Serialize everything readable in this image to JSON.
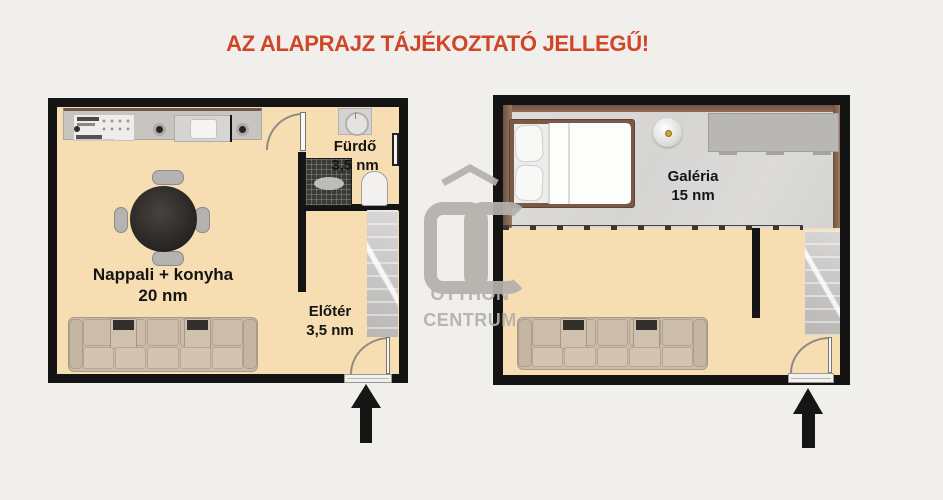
{
  "title": {
    "text": "AZ ALAPRAJZ TÁJÉKOZTATÓ JELLEGŰ!"
  },
  "plans": {
    "left": {
      "rooms": {
        "living": {
          "name": "Nappali + konyha",
          "area": "20 nm"
        },
        "bath": {
          "name": "Fürdő",
          "area": "3,5 nm"
        },
        "hall": {
          "name": "Előtér",
          "area": "3,5 nm"
        }
      }
    },
    "right": {
      "rooms": {
        "gallery": {
          "name": "Galéria",
          "area": "15 nm"
        }
      }
    }
  },
  "watermark": {
    "initials": "OC",
    "line1": "OTTHON",
    "line2": "CENTRUM"
  },
  "icons": {
    "entrance_arrow": "up-arrow",
    "door": "quarter-arc-door",
    "washing_machine": "washer-drum",
    "ceiling_lamp": "sphere-lamp"
  },
  "colors": {
    "background": "#f0efeb",
    "wall": "#141414",
    "floor": "#f7ddb2",
    "title_red": "#cf4628",
    "watermark_gray": "#b4b1ad",
    "wood_trim": "#7b5c48",
    "gallery_floor": "#d9d8d6",
    "sofa_beige": "#c9bba7",
    "stairs_gray": "#c9c7c5"
  }
}
